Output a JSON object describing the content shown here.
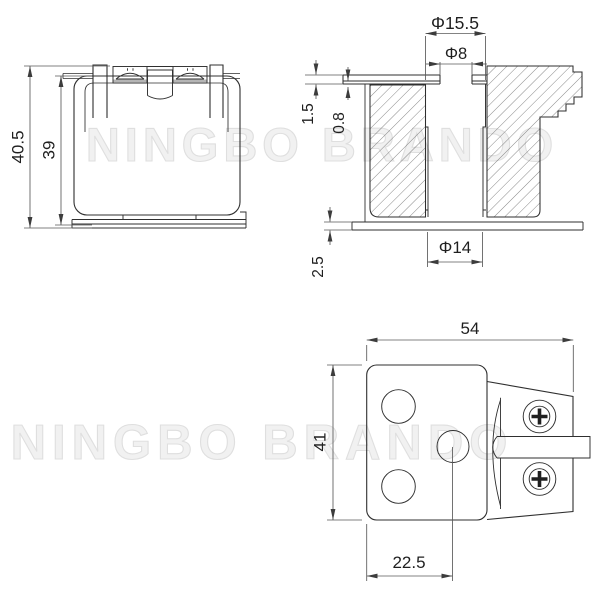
{
  "drawing": {
    "watermark_top": "NINGBO BRANDO",
    "watermark_bottom": "NINGBO BRANDO",
    "front_view": {
      "overall_height": "40.5",
      "body_height": "39"
    },
    "section_view": {
      "top_bore_dia": "Φ15.5",
      "pilot_hole_dia": "Φ8",
      "flange_thickness": "1.5",
      "step_depth": "0.8",
      "base_plate_thickness": "2.5",
      "bottom_bore_dia": "Φ14"
    },
    "bottom_view": {
      "overall_width": "54",
      "overall_depth": "41",
      "hole_center_offset": "22.5"
    }
  },
  "colors": {
    "line": "#2f2f2f",
    "dimension": "#5a5a5a",
    "text": "#1f1f1f",
    "watermark": "#ededed",
    "hatch": "#555555",
    "background": "#ffffff"
  }
}
